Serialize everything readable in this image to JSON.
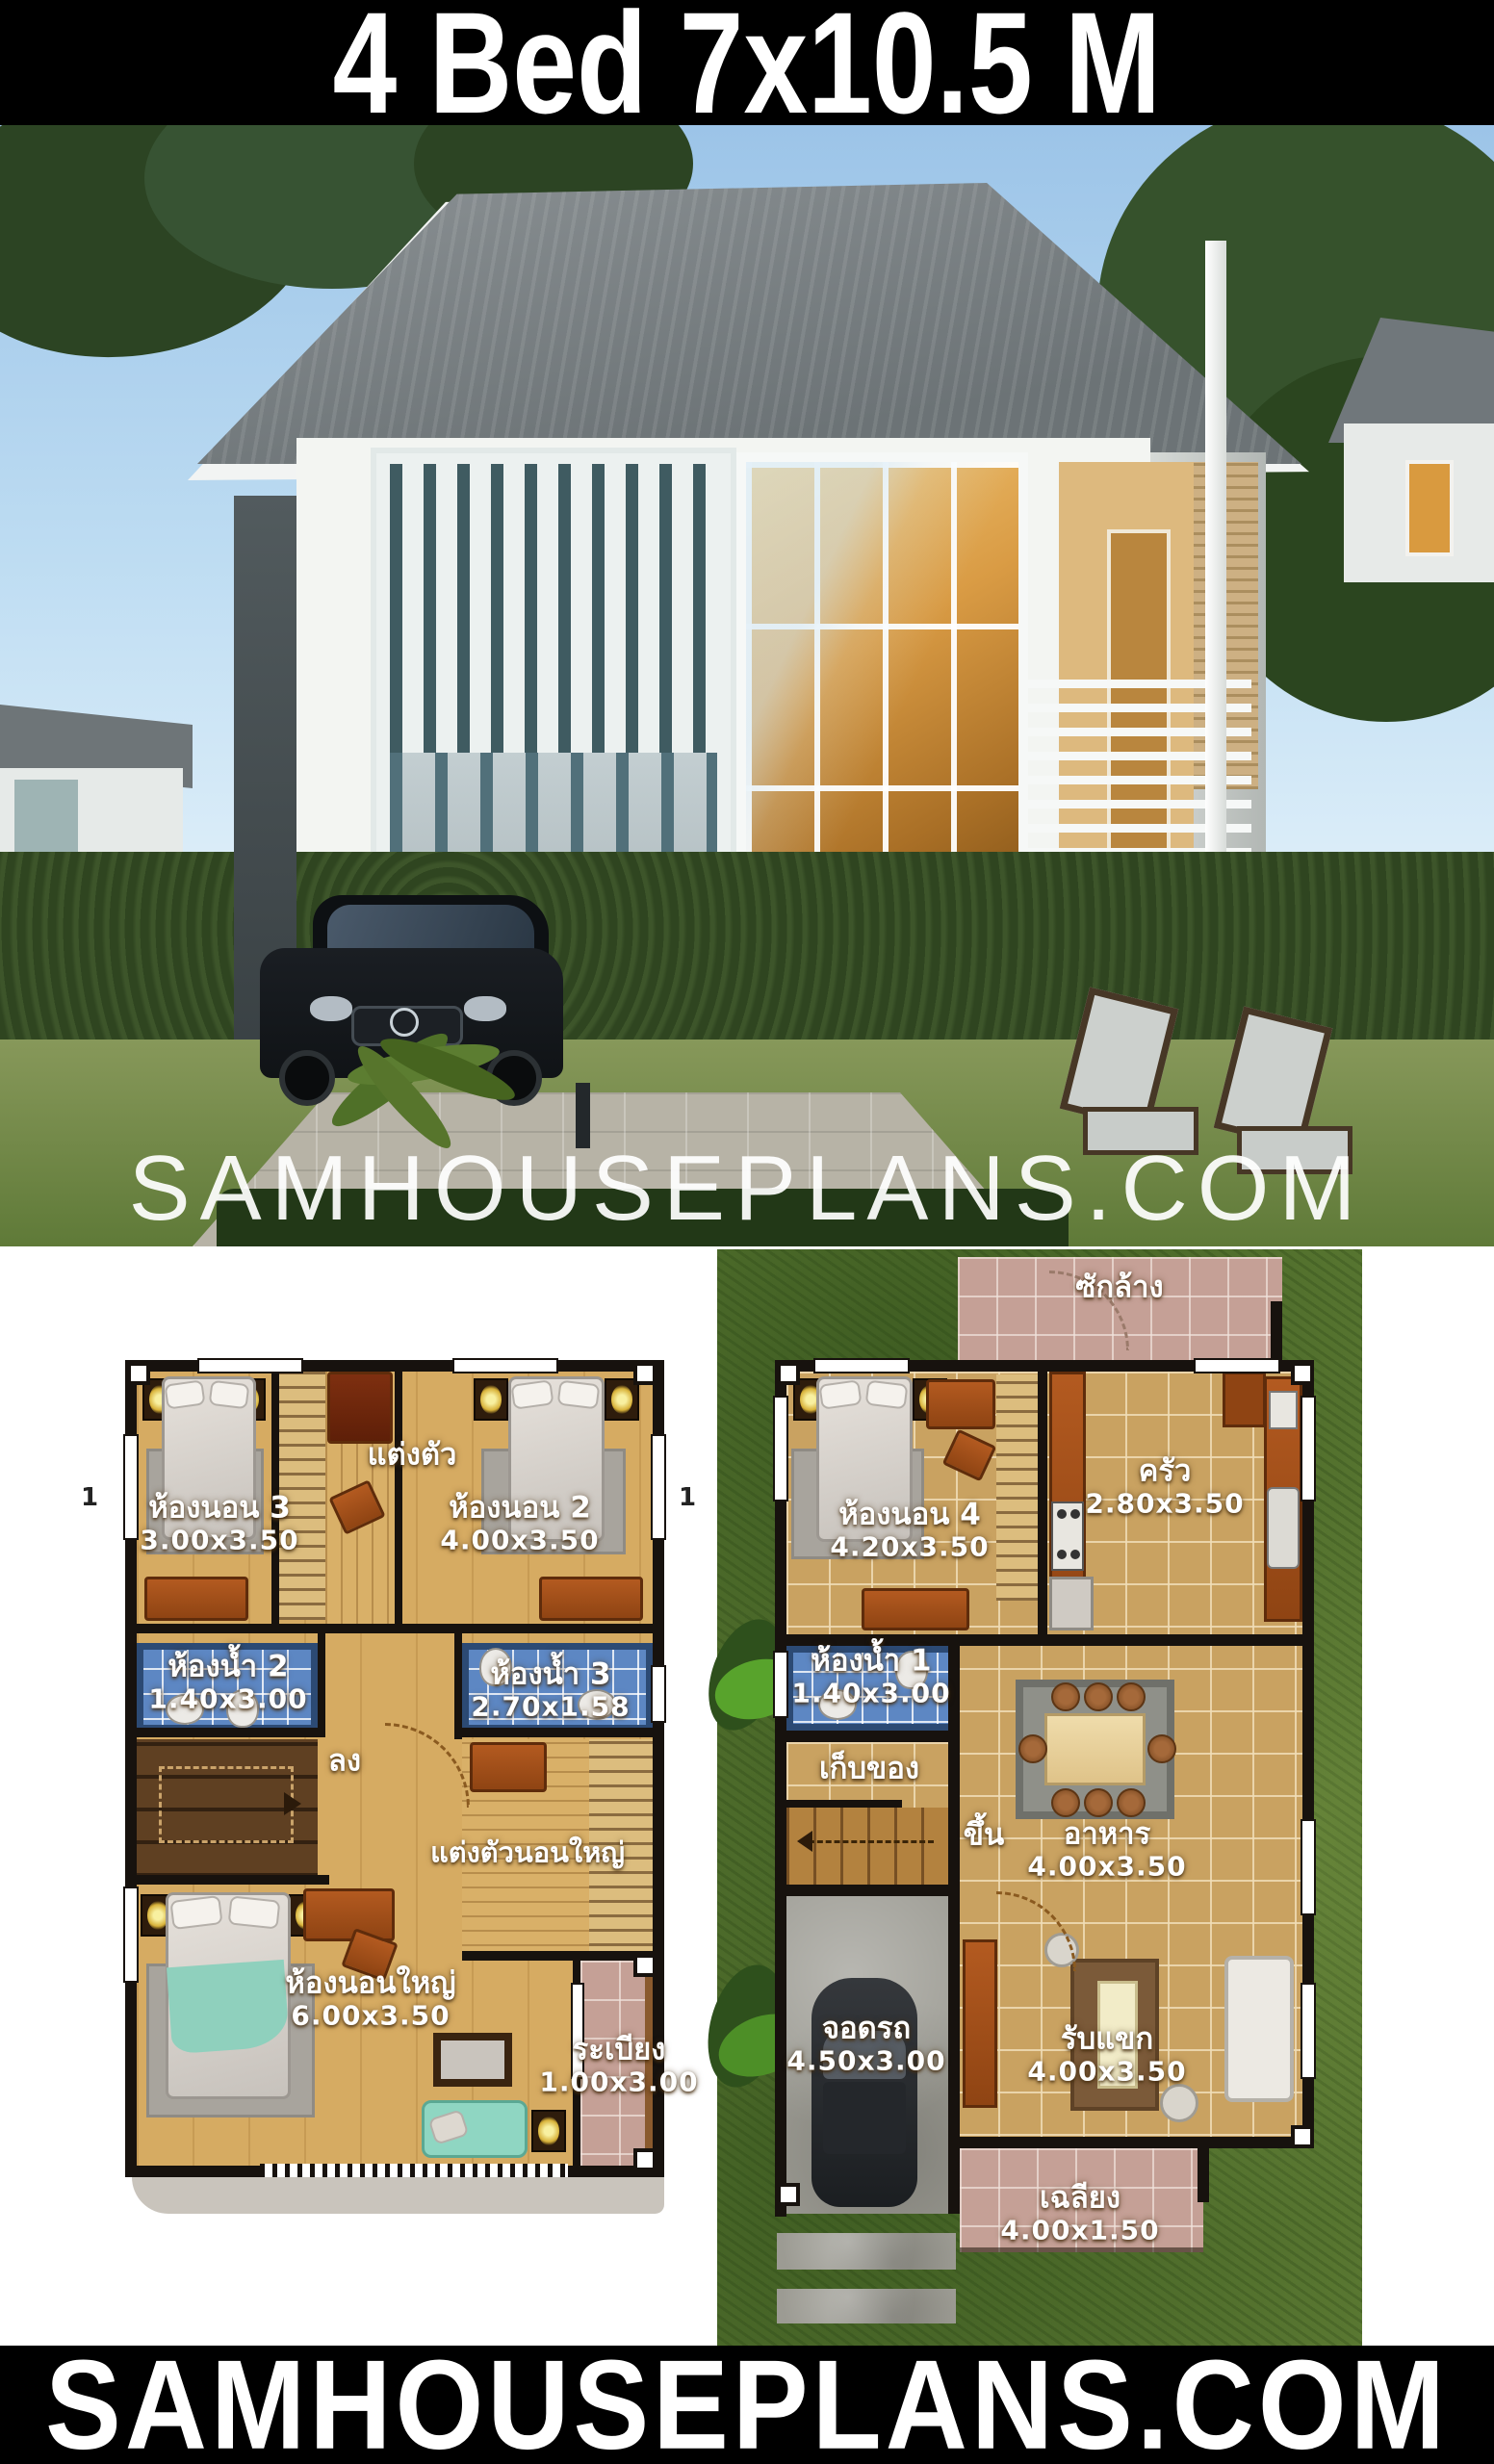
{
  "banner_top": {
    "title": "4 Bed 7x10.5 M"
  },
  "banner_bottom": {
    "title": "SAMHOUSEPLANS.COM"
  },
  "watermark": {
    "text": "SAMHOUSEPLANS.COM"
  },
  "plans": {
    "section_marker": "1",
    "second_floor": {
      "rooms": {
        "bedroom3": {
          "name": "ห้องนอน 3",
          "dims": "3.00x3.50"
        },
        "dressing": {
          "name": "แต่งตัว"
        },
        "bedroom2": {
          "name": "ห้องนอน 2",
          "dims": "4.00x3.50"
        },
        "bath2": {
          "name": "ห้องน้ำ 2",
          "dims": "1.40x3.00"
        },
        "bath3": {
          "name": "ห้องน้ำ 3",
          "dims": "2.70x1.58"
        },
        "down": {
          "name": "ลง"
        },
        "master_dressing": {
          "name": "แต่งตัวนอนใหญ่"
        },
        "master": {
          "name": "ห้องนอนใหญ่",
          "dims": "6.00x3.50"
        },
        "balcony": {
          "name": "ระเบียง",
          "dims": "1.00x3.00"
        }
      }
    },
    "first_floor": {
      "rooms": {
        "laundry": {
          "name": "ซักล้าง"
        },
        "bedroom4": {
          "name": "ห้องนอน 4",
          "dims": "4.20x3.50"
        },
        "kitchen": {
          "name": "ครัว",
          "dims": "2.80x3.50"
        },
        "bath1": {
          "name": "ห้องน้ำ 1",
          "dims": "1.40x3.00"
        },
        "storage": {
          "name": "เก็บของ"
        },
        "up": {
          "name": "ขึ้น"
        },
        "dining": {
          "name": "อาหาร",
          "dims": "4.00x3.50"
        },
        "carpark": {
          "name": "จอดรถ",
          "dims": "4.50x3.00"
        },
        "living": {
          "name": "รับแขก",
          "dims": "4.00x3.50"
        },
        "porch": {
          "name": "เฉลียง",
          "dims": "4.00x1.50"
        }
      }
    }
  },
  "colors": {
    "banner_bg": "#000000",
    "banner_text": "#ffffff",
    "plan_wall": "#17120e",
    "wood_floor": "#d6ab62",
    "bath_blue": "#5d87c3",
    "pink_tile": "#c5a096",
    "grass_green": "#5c7a33",
    "concrete": "#9c9b93",
    "furniture_orange": "#a8551e"
  }
}
